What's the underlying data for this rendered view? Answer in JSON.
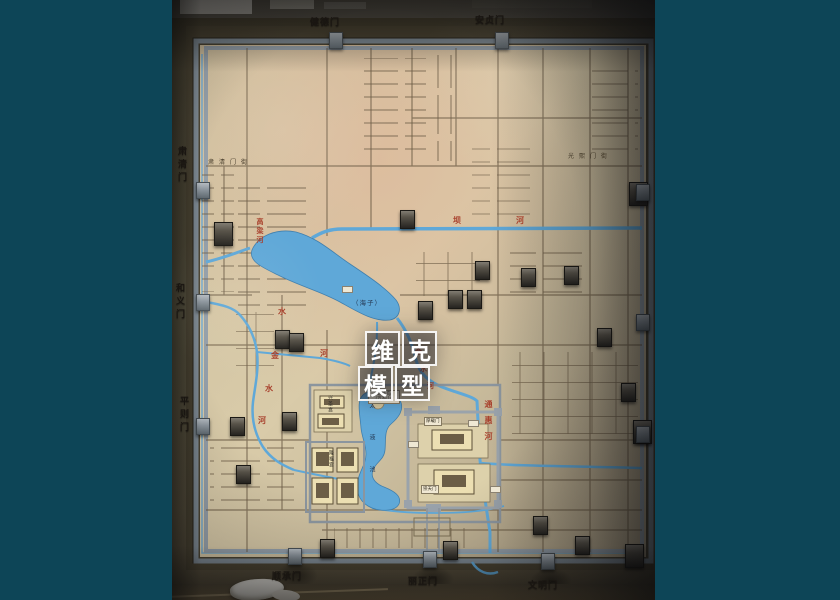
{
  "scene": {
    "type": "photograph of a museum scale model map of the Yuan dynasty capital (Dadu)",
    "letterbox_color": "#0d4557",
    "wall_color": "#55503d",
    "board_wood_color": "#d5c7a3",
    "river_color": "#5fa8d8",
    "street_color": "#6b5b45",
    "frame_color": "#7e8a94",
    "red_label_color": "#a8402c"
  },
  "watermark": {
    "row1": [
      "维",
      "克"
    ],
    "row2": [
      "模",
      "型"
    ]
  },
  "gates": {
    "north": [
      "健德门",
      "安贞门"
    ],
    "west": [
      "肃清门",
      "和义门",
      "平则门"
    ],
    "south": [
      "顺承门",
      "丽正门",
      "文明门"
    ]
  },
  "streets": {
    "northwest": "肃清门街",
    "northeast": "光熙门街"
  },
  "waters": {
    "haizi": "（海子）",
    "bahe": [
      "坝",
      "河"
    ],
    "gaoliang": "高梁河",
    "jinshui_upper": "水",
    "jinshui": [
      "金",
      "水",
      "河"
    ],
    "jinshui_east": "河",
    "jinshui_palace": [
      "金",
      "水",
      "河"
    ],
    "tonghui": "通惠河",
    "taiye": "太液池"
  },
  "imperial_city": {
    "xingshenggong": "兴圣宫",
    "longfugong": "隆福宫",
    "qionghuadao": "琼华岛",
    "wansuishan": "（万岁山）",
    "houzaimen": "厚载门",
    "chongtianmen": "崇天门"
  }
}
